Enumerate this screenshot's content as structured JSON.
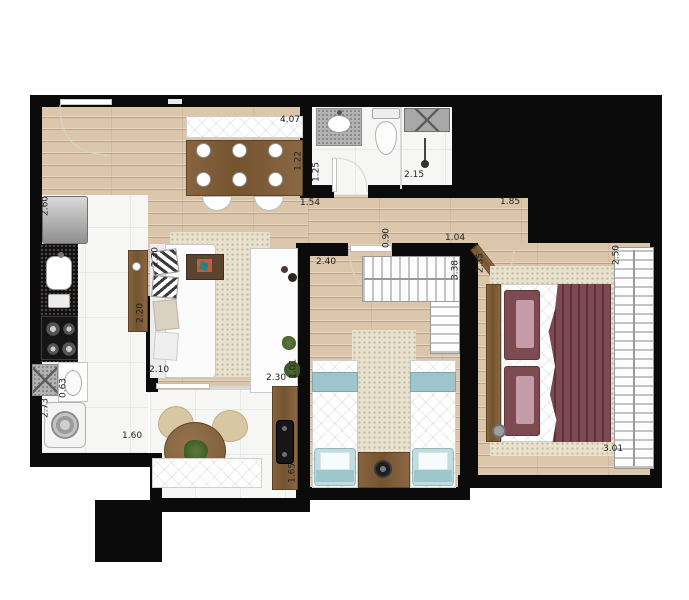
{
  "floorplan": {
    "measurements": {
      "dining_top": "4.07",
      "dining_side": "1.22",
      "kitchen_refrigerator_side": "2.60",
      "bathroom_entry_side": "1.25",
      "bathroom_shower": "2.15",
      "hall_bathroom": "1.54",
      "hall_right": "1.85",
      "hall_passage": "0.90",
      "bedroom1_entry": "1.04",
      "bedroom2_top": "2.40",
      "bedroom2_side": "3.38",
      "bedroom1_side": "2.35",
      "bedroom1_closet_side": "2.50",
      "bedroom1_bottom": "3.01",
      "living_sofa_side": "2.30",
      "living_bottom": "2.10",
      "living_rack_side": "1.01",
      "kitchen_counter_side": "2.20",
      "kitchen_sink_side": "0.63",
      "laundry_side": "2.73",
      "kitchen_bottom": "1.60",
      "balcony_counter_top": "2.30",
      "balcony_counter_side": "1.65"
    },
    "colors": {
      "wall": "#0b0b0b",
      "wood_floor": "#dbc6ac",
      "tile_floor": "#f6f6f5",
      "rug": "#e8e1cd",
      "accent_blue": "#9cc6cc",
      "accent_burgundy": "#7c4952",
      "furniture_wood": "#7a5a37",
      "counter_granite": "#141111"
    }
  }
}
